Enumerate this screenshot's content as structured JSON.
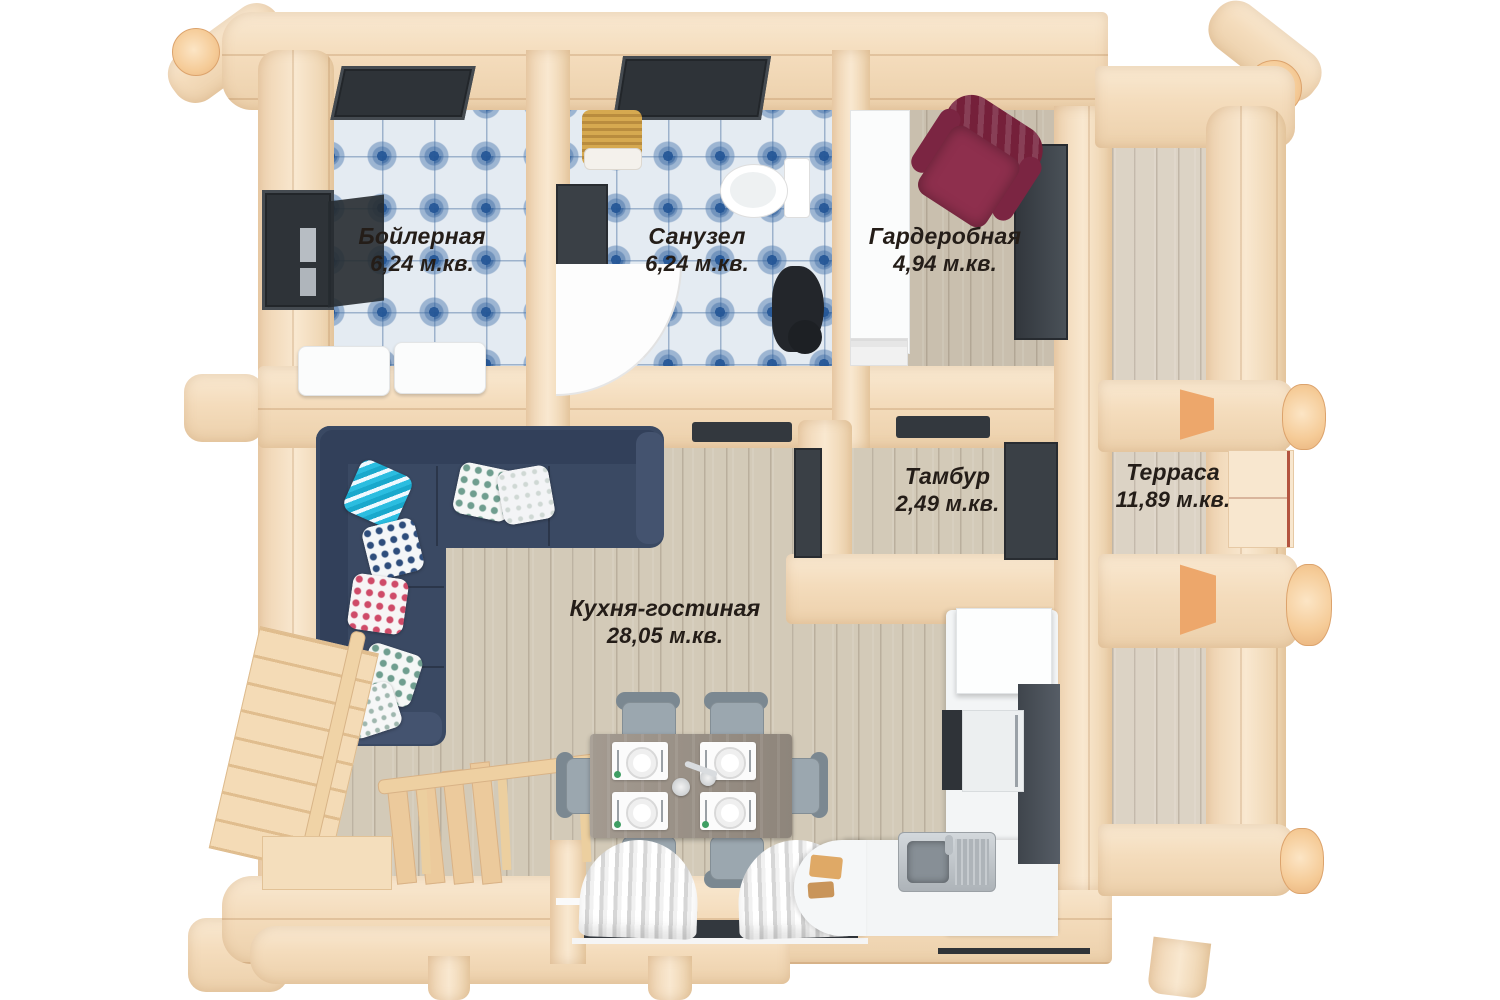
{
  "image": {
    "kind": "3D top-down floor plan render",
    "building": "log house, ground floor"
  },
  "rooms": [
    {
      "name": "Бойлерная",
      "area": "6,24 м.кв."
    },
    {
      "name": "Санузел",
      "area": "6,24 м.кв."
    },
    {
      "name": "Гардеробная",
      "area": "4,94 м.кв."
    },
    {
      "name": "Тамбур",
      "area": "2,49 м.кв."
    },
    {
      "name": "Кухня-гостиная",
      "area": "28,05 м.кв."
    },
    {
      "name": "Терраса",
      "area": "11,89 м.кв."
    }
  ],
  "colors": {
    "background": "#ffffff",
    "wood_light": "#f6e3c9",
    "wood_shadow": "#ecd0ab",
    "log_cut_end": "#f5cb97",
    "tile_blue": "#3a6aa4",
    "tile_base": "#e4ebf2",
    "plank_floor": "#d3cab8",
    "sofa_navy": "#3a4963",
    "armchair_maroon": "#8e2f4d",
    "kitchen_white": "#f3f5f6",
    "dark_frame": "#33383e",
    "label_text": "#241d18"
  }
}
